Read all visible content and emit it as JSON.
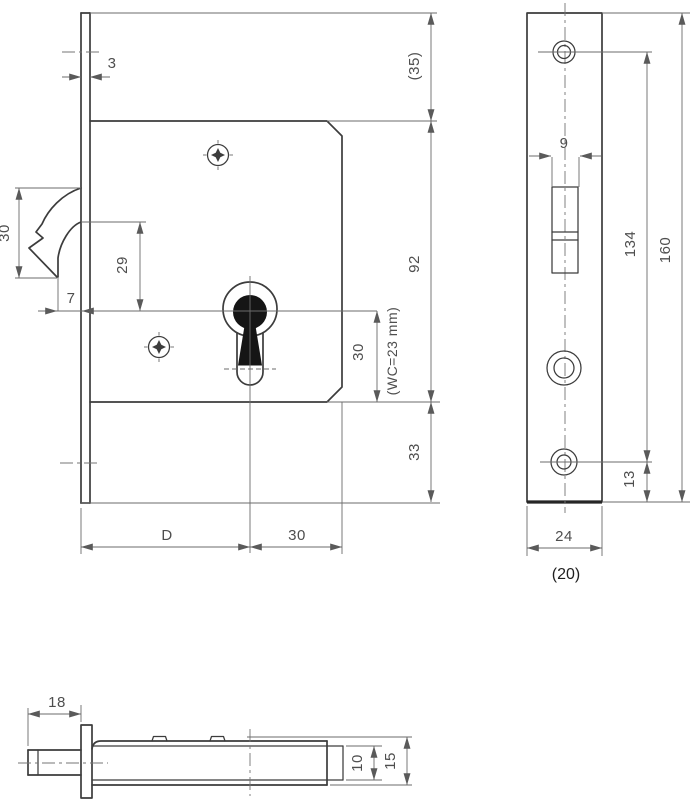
{
  "drawing": {
    "left_view": {
      "label": "lock case side view",
      "dims": {
        "faceplate_thickness": "3",
        "hook_height": "30",
        "hook_tip_offset": "7",
        "key_center_offset": "29",
        "top_margin": "(35)",
        "case_height": "92",
        "key_to_case_bottom": "30",
        "wc_note": "(WC=23 mm)",
        "bottom_margin": "33",
        "backset": "D",
        "center_to_case_back": "30"
      }
    },
    "front_view": {
      "label": "faceplate front view",
      "dims": {
        "slot_width": "9",
        "hole_spacing": "134",
        "plate_length": "160",
        "bottom_hole_offset": "13",
        "plate_width": "24",
        "plate_width_alt": "(20)"
      }
    },
    "top_view": {
      "label": "lock top view",
      "dims": {
        "hook_protrusion": "18",
        "case_thickness": "10",
        "overall_thickness": "15"
      }
    }
  }
}
